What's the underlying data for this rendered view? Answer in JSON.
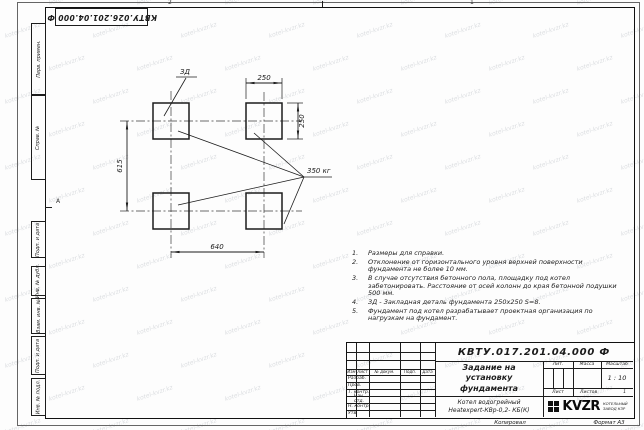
{
  "watermark": {
    "text": "kotel-kvzr.kz"
  },
  "frame": {
    "zone_top_left": "2",
    "zone_top_right": "1",
    "zone_left": "А"
  },
  "top_stamp": {
    "doc_number": "КВТУ.026.201.04.000 Ф"
  },
  "left_margin": {
    "boxes": [
      "Перв. примен.",
      "Справ. №",
      "Подп. и дата",
      "Инв. № дубл.",
      "Взам. инв. №",
      "Подп. и дата",
      "Инв. № подл."
    ]
  },
  "drawing": {
    "detail_label": "ЗД",
    "load_label": "350 кг",
    "dim_width_top": "250",
    "dim_height_right": "250",
    "dim_vertical_left": "615",
    "dim_horizontal_bottom": "640"
  },
  "notes": {
    "numbers": [
      "1.",
      "2.",
      "3.",
      "4.",
      "5."
    ],
    "items": [
      "Размеры для справки.",
      "Отклонение от горизонтального уровня верхней поверхности фундамента не более 10 мм.",
      "В случае отсутствия бетонного пола, площадку под котел забетонировать. Расстояние от осей колонн до края бетонной подушки 500 мм.",
      "ЗД - Закладная деталь фундамента 250х250 S=8.",
      "Фундамент под котел разрабатывает проектная организация по нагрузкам на фундамент."
    ]
  },
  "title_block": {
    "doc_number": "КВТУ.017.201.04.000 Ф",
    "title": "Задание на установку фундамента",
    "product_line1": "Котел водогрейный",
    "product_line2": "Heatexpert-КВр-0,2- КБ(К)",
    "header_cols": {
      "izm": "Изм",
      "list": "Лист",
      "doc": "№ докум.",
      "sign": "Подп.",
      "date": "Дата"
    },
    "role_rows": [
      "Разраб.",
      "Пров.",
      "Т. контр.",
      "Нач. отд.",
      "Н. контр.",
      "Утв."
    ],
    "lit_label": "Лит.",
    "mass_label": "Масса",
    "scale_label": "Масштаб",
    "scale_value": "1 : 10",
    "sheet_label": "Лист",
    "sheets_label": "Листов",
    "sheets_value": "1",
    "logo": {
      "text": "KVZR",
      "caption_line1": "КОТЕЛЬНЫЙ",
      "caption_line2": "ЗАВОД КЗР"
    }
  },
  "bottom_strip": {
    "copied": "Копировал",
    "format": "Формат А3"
  }
}
